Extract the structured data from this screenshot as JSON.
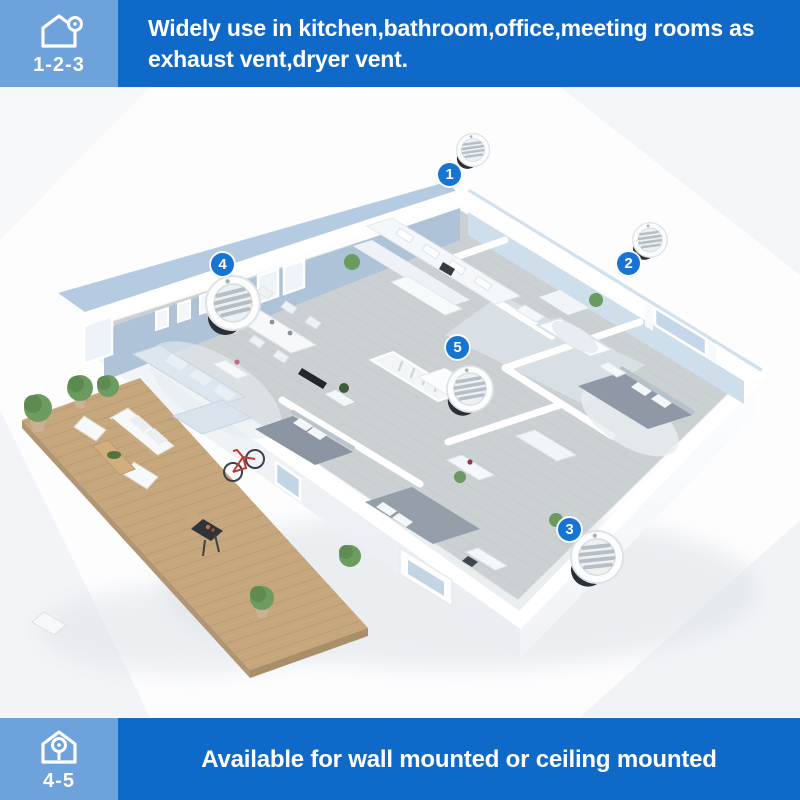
{
  "header": {
    "badge_label": "1-2-3",
    "banner_line1": "Widely use in kitchen,bathroom,office,meeting rooms as",
    "banner_line2": "exhaust vent,dryer vent."
  },
  "footer": {
    "badge_label": "4-5",
    "banner": "Available for wall mounted or ceiling mounted"
  },
  "markers": [
    {
      "label": "1"
    },
    {
      "label": "2"
    },
    {
      "label": "3"
    },
    {
      "label": "4"
    },
    {
      "label": "5"
    }
  ],
  "icons": {
    "header_badge": "house-with-wall-vent-icon",
    "footer_badge": "house-with-ceiling-vent-icon",
    "callout": "round-louvered-vent"
  },
  "colors": {
    "banner_blue": "#0f69c9",
    "badge_blue": "#6da2db",
    "marker_blue": "#1774d3"
  }
}
